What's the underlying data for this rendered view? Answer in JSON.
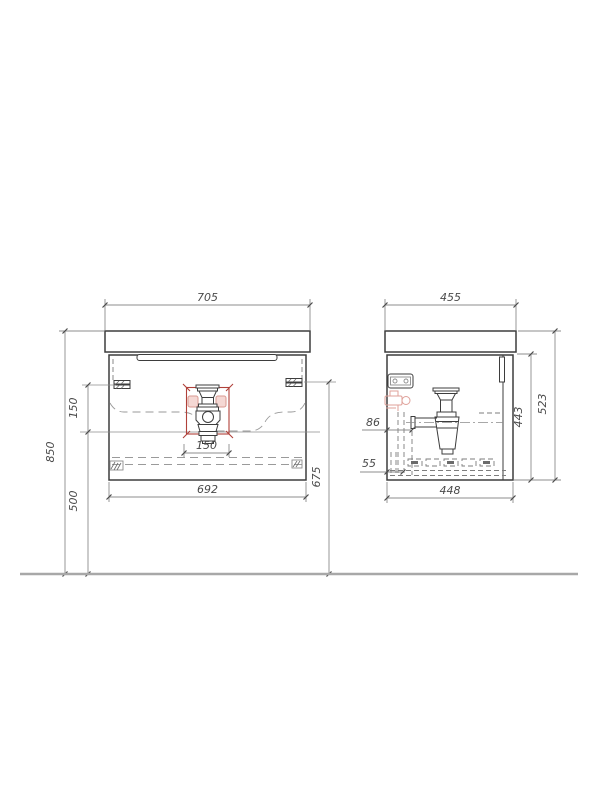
{
  "drawing": {
    "front_view": {
      "top_width": "705",
      "overall_height": "850",
      "drain_height": "500",
      "bracket_to_drain": "150",
      "drain_cutout_width": "150",
      "cabinet_width": "692",
      "rail_to_floor": "675"
    },
    "side_view": {
      "top_depth": "455",
      "cabinet_depth": "448",
      "cabinet_height": "443",
      "overall_side_height": "523",
      "pipe_offset": "86",
      "slide_offset": "55"
    },
    "colors": {
      "outline": "#3d3d3d",
      "dimension_line": "#8c8c8c",
      "dimension_text": "#4a4a4a",
      "highlight_red": "#b0413a",
      "highlight_pink_fill": "#f5d8d4",
      "floor_line": "#a8a8a8"
    }
  }
}
